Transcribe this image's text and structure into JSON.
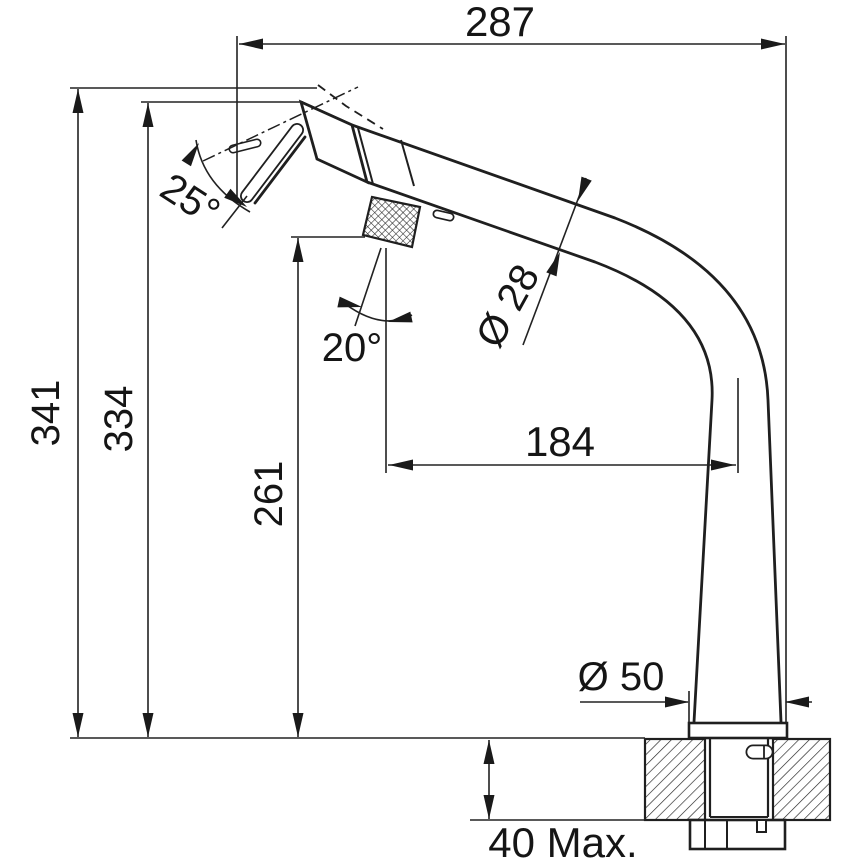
{
  "drawing": {
    "dimensions": {
      "overall_width": "287",
      "overall_height": "341",
      "spout_tip_height": "334",
      "knob_height": "261",
      "spout_reach": "184",
      "spout_diameter": "Ø 28",
      "base_diameter": "Ø 50",
      "counter_thickness_max": "40 Max.",
      "spray_head_swivel_angle": "25°",
      "lever_angle": "20°"
    }
  }
}
